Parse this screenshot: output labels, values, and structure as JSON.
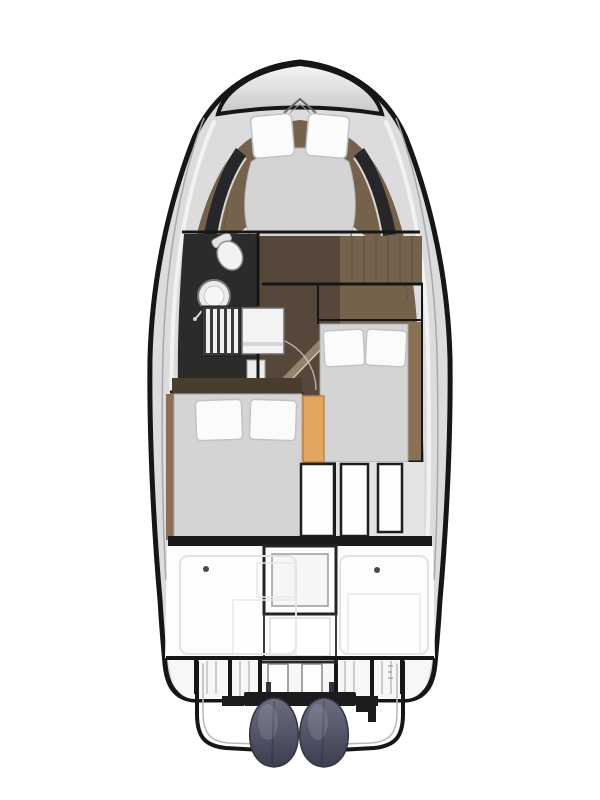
{
  "meta": {
    "title": "motor-yacht-deck-plan-top-view",
    "canvas": {
      "width": 600,
      "height": 800
    },
    "background": "#ffffff"
  },
  "colors": {
    "hull_outline": "#161616",
    "deck_silver": "#dcdcde",
    "deck_highlight": "#f2f2f3",
    "deck_shadow": "#a9a9ab",
    "foredeck_top": "#f6f6f7",
    "foredeck_bottom": "#c7c7c9",
    "chevron_dark": "#6a6a6e",
    "chevron_light": "#9a9a9e",
    "wood_floor": "#75624d",
    "wood_dark": "#55473a",
    "wood_plank": "#4a3d2f",
    "wood_light": "#8a7156",
    "door_diag": "#93826c",
    "door_diag_light": "#cfc6b8",
    "dark_trim": "#27272a",
    "head_floor": "#2b2b29",
    "mattress": "#d4d4d5",
    "mattress_edge": "#a8a8aa",
    "pillow": "#fbfbfb",
    "pillow_edge": "#c2c2c4",
    "seat_orange": "#e3a660",
    "seat_orange_edge": "#bf8343",
    "white_panel": "#fdfdfd",
    "panel_frame": "#1d1d1d",
    "silver_gap": "#e3e3e5",
    "mid_band": "#1b1b1d",
    "cockpit_floor": "#fdfdfd",
    "hatch_frame": "#242424",
    "hatch_inner": "#f6f6f7",
    "hatch_inner_edge": "#9c9c9e",
    "latch_dot": "#4a4a4c",
    "steps_floor": "#f7f7f8",
    "steps_dark": "#3b3b3d",
    "step_slat": "#f0f0f1",
    "fixture_white": "#f2f2f2",
    "fixture_mid": "#e4e4e6",
    "fixture_edge": "#8f8f8f",
    "sink_outer": "#ebebec",
    "sink_rim": "#77777a",
    "counter_white": "#f3f3f4",
    "counter_edge": "#6f6f72",
    "engine_top": "#6b6d81",
    "engine_bottom": "#3c3f50",
    "engine_edge": "#32343f",
    "bracket_black": "#1c1c1e"
  },
  "plan": {
    "bow_cabin": {
      "bed": "v-berth-island-bed",
      "pillow_count": 2
    },
    "head": {
      "fixtures": [
        "toilet",
        "round-washbasin",
        "companionway-steps",
        "vanity-counter"
      ]
    },
    "starboard_cabin": {
      "bed": "double-berth",
      "pillow_count": 2
    },
    "port_cabin": {
      "bed": "double-berth",
      "pillow_count": 2
    },
    "cockpit": {
      "hatch": "central-engine-hatch",
      "latch_count": 2
    },
    "stern": {
      "engine_count": 2,
      "swim_platform_count": 2
    }
  }
}
